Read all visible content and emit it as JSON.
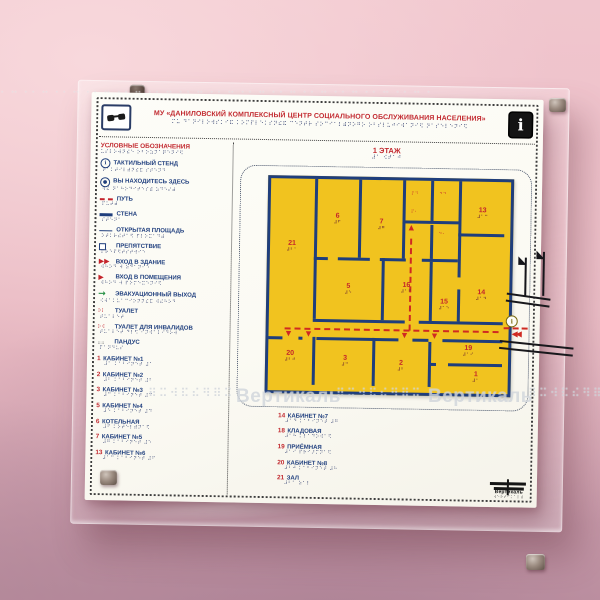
{
  "icons": {
    "down": "▼",
    "up": "▲",
    "left_double": "◀◀",
    "flag": "◣",
    "info": "i",
    "stand": "i",
    "dot": "●"
  },
  "watermark": {
    "text": "Вертикаль",
    "dots": "⠿⠭⠺⠯⠮⠻⠿⠭",
    "top_dots": "⠂⠒⠐⠂⠒⠐⠂⠒⠐⠂⠒⠐⠂⠒⠐⠂⠒⠐⠂⠒⠐⠂⠒⠐⠂⠒⠐⠂⠒⠐⠂⠒⠐⠂⠒⠐⠂⠒⠐⠂⠒⠐"
  },
  "sign": {
    "header": {
      "title": "МУ «ДАНИЛОВСКИЙ КОМПЛЕКСНЫЙ ЦЕНТР СОЦИАЛЬНОГО ОБСЛУЖИВАНИЯ НАСЕЛЕНИЯ»",
      "title_braille": "⠍⠥ ⠙⠁⠝⠊⠇⠕⠺⠎⠅⠊⠯ ⠅⠕⠍⠏⠇⠑⠅⠎⠝⠮⠯ ⠉⠑⠝⠞⠗ ⠎⠕⠉⠊⠁⠇⠾⠝⠕⠛⠕ ⠕⠃⠎⠇⠥⠚⠊⠺⠁⠝⠊⠫ ⠝⠁⠎⠑⠇⠑⠝⠊⠫",
      "info_glyph": "i"
    },
    "legend": {
      "title": "УСЛОВНЫЕ ОБОЗНАЧЕНИЯ",
      "title_braille": "⠥⠎⠇⠕⠺⠝⠮⠑ ⠕⠃⠕⠵⠝⠁⠟⠑⠝⠊⠫",
      "items": [
        {
          "icon": "tactile-stand-icon",
          "kind": "circle",
          "glyph": "i",
          "label": "ТАКТИЛЬНЫЙ СТЕНД",
          "braille": "⠞⠁⠅⠞⠊⠇⠾⠝⠮⠯ ⠎⠞⠑⠝⠙"
        },
        {
          "icon": "you-are-here-icon",
          "kind": "circle",
          "glyph": "●",
          "label": "ВЫ НАХОДИТЕСЬ ЗДЕСЬ",
          "braille": "⠺⠮ ⠝⠁⠓⠕⠙⠊⠞⠑⠎⠾ ⠵⠙⠑⠎⠾"
        },
        {
          "icon": "path-line-icon",
          "kind": "line-dash",
          "glyph": "",
          "label": "ПУТЬ",
          "braille": "⠏⠥⠞⠾"
        },
        {
          "icon": "wall-line-icon",
          "kind": "line-wall",
          "glyph": "",
          "label": "СТЕНА",
          "braille": "⠎⠞⠑⠝⠁"
        },
        {
          "icon": "open-area-line-icon",
          "kind": "line-thin",
          "glyph": "",
          "label": "ОТКРЫТАЯ ПЛОЩАДЬ",
          "braille": "⠕⠞⠅⠗⠮⠞⠁⠫ ⠏⠇⠕⠭⠁⠙⠾"
        },
        {
          "icon": "obstacle-icon",
          "kind": "square",
          "glyph": "",
          "label": "ПРЕПЯТСТВИЕ",
          "braille": "⠏⠗⠑⠏⠫⠞⠎⠞⠺⠊⠑"
        },
        {
          "icon": "building-entrance-icon",
          "kind": "arrow-red",
          "glyph": "▶▶",
          "label": "ВХОД В ЗДАНИЕ",
          "braille": "⠺⠓⠕⠙ ⠺ ⠵⠙⠁⠝⠊⠑"
        },
        {
          "icon": "room-entrance-icon",
          "kind": "arrow-red",
          "glyph": "▶",
          "label": "ВХОД В ПОМЕЩЕНИЯ",
          "braille": "⠺⠓⠕⠙ ⠺ ⠏⠕⠍⠑⠭⠑⠝⠊⠫"
        },
        {
          "icon": "emergency-exit-icon",
          "kind": "arrow-green",
          "glyph": "→",
          "label": "ЭВАКУАЦИОННЫЙ ВЫХОД",
          "braille": "⠪⠺⠁⠅⠥⠁⠉⠊⠕⠝⠝⠮⠯ ⠺⠮⠓⠕⠙"
        },
        {
          "icon": "toilet-icon",
          "kind": "braille-red",
          "glyph": "⠗⠇",
          "label": "ТУАЛЕТ",
          "braille": "⠞⠥⠁⠇⠑⠞"
        },
        {
          "icon": "accessible-toilet-icon",
          "kind": "braille-red",
          "glyph": "⠗⠺",
          "label": "ТУАЛЕТ ДЛЯ ИНВАЛИДОВ",
          "braille": "⠞⠥⠁⠇⠑⠞ ⠙⠇⠫ ⠊⠝⠺⠁⠇⠊⠙⠕⠺"
        },
        {
          "icon": "ramp-icon",
          "kind": "braille-gray",
          "glyph": "⠶⠶",
          "label": "ПАНДУС",
          "braille": "⠏⠁⠝⠙⠥⠎"
        }
      ],
      "rooms_left": [
        {
          "num": "1",
          "label": "КАБИНЕТ №1",
          "braille": "⠼⠁ ⠅⠁⠃⠊⠝⠑⠞ ⠼⠁"
        },
        {
          "num": "2",
          "label": "КАБИНЕТ №2",
          "braille": "⠼⠃ ⠅⠁⠃⠊⠝⠑⠞ ⠼⠃"
        },
        {
          "num": "3",
          "label": "КАБИНЕТ №3",
          "braille": "⠼⠉ ⠅⠁⠃⠊⠝⠑⠞ ⠼⠉"
        },
        {
          "num": "5",
          "label": "КАБИНЕТ №4",
          "braille": "⠼⠑ ⠅⠁⠃⠊⠝⠑⠞ ⠼⠙"
        },
        {
          "num": "6",
          "label": "КОТЕЛЬНАЯ",
          "braille": "⠼⠋ ⠅⠕⠞⠑⠇⠾⠝⠁⠫"
        },
        {
          "num": "7",
          "label": "КАБИНЕТ №5",
          "braille": "⠼⠛ ⠅⠁⠃⠊⠝⠑⠞ ⠼⠑"
        },
        {
          "num": "13",
          "label": "КАБИНЕТ №6",
          "braille": "⠼⠁⠉ ⠅⠁⠃⠊⠝⠑⠞ ⠼⠋"
        }
      ],
      "rooms_bottom": [
        {
          "num": "14",
          "label": "КАБИНЕТ №7",
          "braille": "⠼⠁⠙ ⠅⠁⠃⠊⠝⠑⠞ ⠼⠛"
        },
        {
          "num": "18",
          "label": "КЛАДОВАЯ",
          "braille": "⠼⠁⠓ ⠅⠇⠁⠙⠕⠺⠁⠫"
        },
        {
          "num": "19",
          "label": "ПРИЁМНАЯ",
          "braille": "⠼⠁⠊ ⠏⠗⠊⠜⠍⠝⠁⠫"
        },
        {
          "num": "20",
          "label": "КАБИНЕТ №8",
          "braille": "⠼⠃⠚ ⠅⠁⠃⠊⠝⠑⠞ ⠼⠓"
        },
        {
          "num": "21",
          "label": "ЗАЛ",
          "braille": "⠼⠃⠁ ⠵⠁⠇"
        }
      ]
    },
    "plan": {
      "title": "1 ЭТАЖ",
      "title_braille": "⠼⠁ ⠪⠞⠁⠚",
      "rooms": [
        {
          "num": "21",
          "braille": "⠼⠃⠁",
          "x": 22,
          "y": 68
        },
        {
          "num": "20",
          "braille": "⠼⠃⠚",
          "x": 22,
          "y": 178
        },
        {
          "num": "6",
          "braille": "⠼⠋",
          "x": 67,
          "y": 40
        },
        {
          "num": "7",
          "braille": "⠼⠛",
          "x": 111,
          "y": 45
        },
        {
          "num": "13",
          "braille": "⠼⠁⠉",
          "x": 212,
          "y": 32
        },
        {
          "num": "5",
          "braille": "⠼⠑",
          "x": 79,
          "y": 110
        },
        {
          "num": "16",
          "braille": "⠼⠁⠋",
          "x": 137,
          "y": 108
        },
        {
          "num": "15",
          "braille": "⠼⠁⠑",
          "x": 175,
          "y": 124
        },
        {
          "num": "14",
          "braille": "⠼⠁⠙",
          "x": 212,
          "y": 114
        },
        {
          "num": "3",
          "braille": "⠼⠉",
          "x": 77,
          "y": 182
        },
        {
          "num": "2",
          "braille": "⠼⠃",
          "x": 133,
          "y": 186
        },
        {
          "num": "19",
          "braille": "⠼⠁⠊",
          "x": 200,
          "y": 170
        },
        {
          "num": "1",
          "braille": "⠼⠁",
          "x": 208,
          "y": 196
        }
      ],
      "cell_marks": [
        {
          "glyph": "⠏⠙",
          "x": 144,
          "y": 14
        },
        {
          "glyph": "⠙⠙",
          "x": 172,
          "y": 14
        },
        {
          "glyph": "⠏⠂",
          "x": 144,
          "y": 32
        },
        {
          "glyph": "⠙⠂",
          "x": 172,
          "y": 54
        }
      ]
    },
    "footer_logo": "Вертикаль",
    "footer_logo_braille": "⠺⠑⠗⠞⠊⠅⠁⠇⠾"
  }
}
